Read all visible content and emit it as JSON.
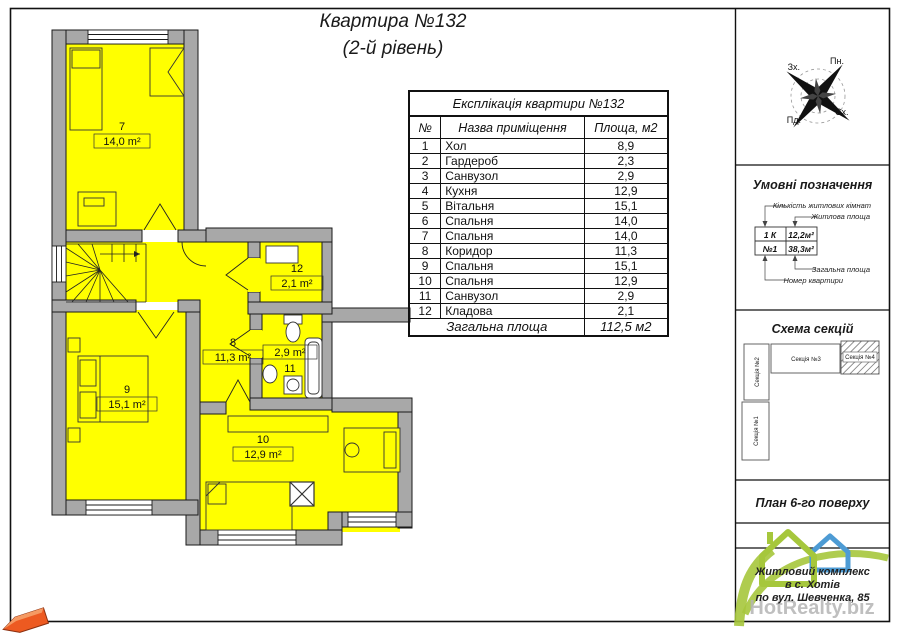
{
  "title": {
    "line1": "Квартира №132",
    "line2": "(2-й рівень)"
  },
  "table": {
    "caption": "Експлікація квартири №132",
    "columns": [
      "№",
      "Назва приміщення",
      "Площа, м2"
    ],
    "rows": [
      [
        "1",
        "Хол",
        "8,9"
      ],
      [
        "2",
        "Гардероб",
        "2,3"
      ],
      [
        "3",
        "Санвузол",
        "2,9"
      ],
      [
        "4",
        "Кухня",
        "12,9"
      ],
      [
        "5",
        "Вітальня",
        "15,1"
      ],
      [
        "6",
        "Спальня",
        "14,0"
      ],
      [
        "7",
        "Спальня",
        "14,0"
      ],
      [
        "8",
        "Коридор",
        "11,3"
      ],
      [
        "9",
        "Спальня",
        "15,1"
      ],
      [
        "10",
        "Спальня",
        "12,9"
      ],
      [
        "11",
        "Санвузол",
        "2,9"
      ],
      [
        "12",
        "Кладова",
        "2,1"
      ]
    ],
    "footer": {
      "label": "Загальна площа",
      "value": "112,5 м2"
    }
  },
  "compass": {
    "north": "Пн.",
    "south": "Пд.",
    "west": "Зх.",
    "east": "Сх."
  },
  "legend": {
    "title": "Умовні позначення",
    "labels": {
      "rooms_count": "Кількість житлових кімнат",
      "living_area": "Житлова площа",
      "total_area": "Загальна площа",
      "apt_number": "Номер квартири"
    },
    "sample": {
      "rooms": "1 К",
      "living": "12,2м²",
      "number": "№1",
      "total": "38,3м²"
    }
  },
  "scheme": {
    "title": "Схема секцій",
    "sections": [
      {
        "label": "Секція №1"
      },
      {
        "label": "Секція №2"
      },
      {
        "label": "Секція №3"
      },
      {
        "label": "Секція №4"
      }
    ]
  },
  "floor_label": "План 6-го поверху",
  "address": {
    "line1": "Житловий комплекс",
    "line2": "в с. Хотів",
    "line3": "по вул. Шевченка, 85"
  },
  "watermark": "HotRealty.biz",
  "plan": {
    "rooms": [
      {
        "number": "7",
        "area": "14,0 m²"
      },
      {
        "number": "12",
        "area": "2,1 m²"
      },
      {
        "number": "8",
        "area": "11,3 m²"
      },
      {
        "number": "11",
        "area": "2,9 m²"
      },
      {
        "number": "9",
        "area": "15,1 m²"
      },
      {
        "number": "10",
        "area": "12,9 m²"
      }
    ]
  },
  "colors": {
    "room_fill": "#ffff00",
    "wall_fill": "#a8a8a8",
    "accent_green": "#a6c73c",
    "accent_blue": "#4d9bd4",
    "watermark_gray": "#b5b5b5",
    "arrow_orange": "#ed5a21"
  }
}
